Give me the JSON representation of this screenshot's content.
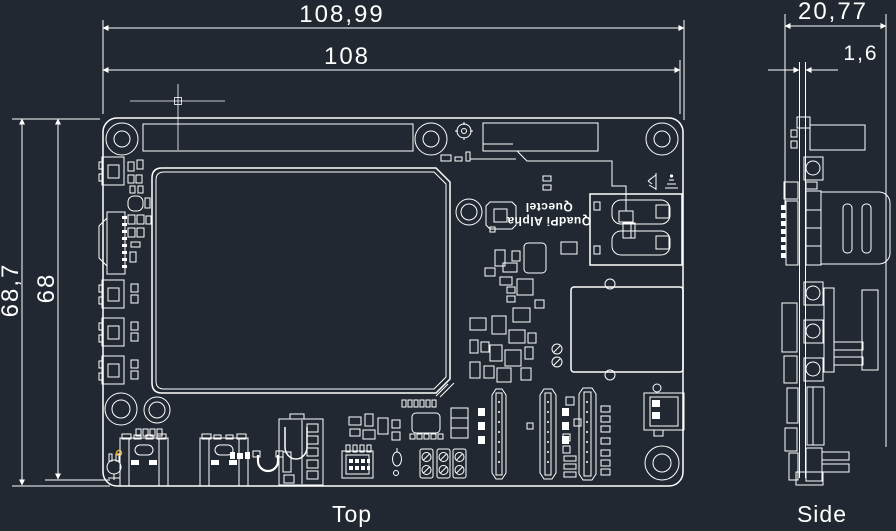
{
  "canvas": {
    "background": "#222831",
    "line_color": "#ffffff",
    "marker_color": "#e0a526"
  },
  "top_view": {
    "label": "Top",
    "dim_overall_width": "108,99",
    "dim_pcb_width": "108",
    "dim_overall_height": "68,7",
    "dim_pcb_height": "68",
    "silkscreen_line1": "QuadPi Alpha",
    "silkscreen_line2": "Quectel"
  },
  "side_view": {
    "label": "Side",
    "dim_overall_thickness": "20,77",
    "dim_pcb_thickness": "1,6"
  }
}
